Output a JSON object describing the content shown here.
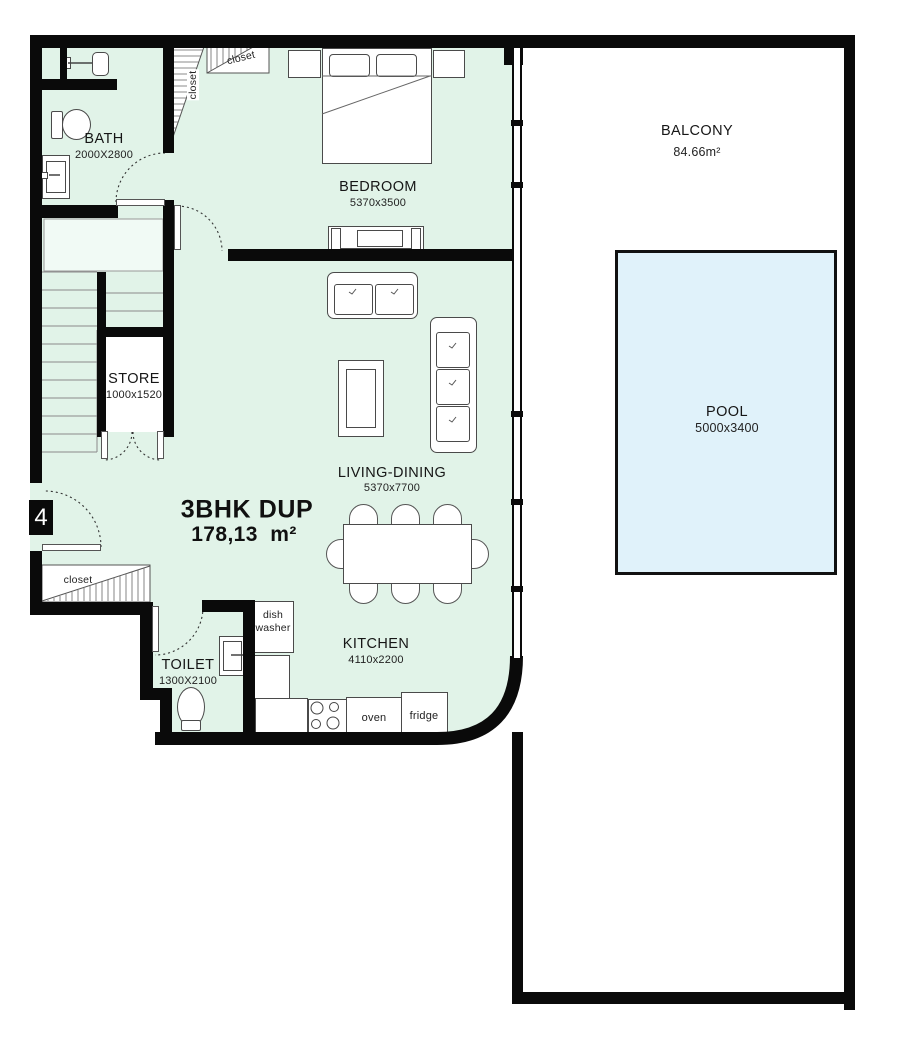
{
  "plan": {
    "unit_number": "4",
    "title_name": "3BHK DUP",
    "title_area": "178,13  m²"
  },
  "rooms": {
    "bath": {
      "name": "BATH",
      "dims": "2000X2800"
    },
    "bedroom": {
      "name": "BEDROOM",
      "dims": "5370x3500"
    },
    "balcony": {
      "name": "BALCONY",
      "dims": "84.66m²"
    },
    "pool": {
      "name": "POOL",
      "dims": "5000x3400"
    },
    "store": {
      "name": "STORE",
      "dims": "1000x1520"
    },
    "living_dining": {
      "name": "LIVING-DINING",
      "dims": "5370x7700"
    },
    "kitchen": {
      "name": "KITCHEN",
      "dims": "4110x2200"
    },
    "toilet": {
      "name": "TOILET",
      "dims": "1300X2100"
    }
  },
  "fixtures": {
    "closet": "closet",
    "dish_line1": "dish",
    "dish_line2": "washer",
    "oven": "oven",
    "fridge": "fridge"
  },
  "colors": {
    "wall": "#0a0a0a",
    "floor_fill": "#e1f3e8",
    "pool_fill": "#e0f2fa",
    "pool_border": "#111111",
    "balcony_fill": "#ffffff"
  }
}
